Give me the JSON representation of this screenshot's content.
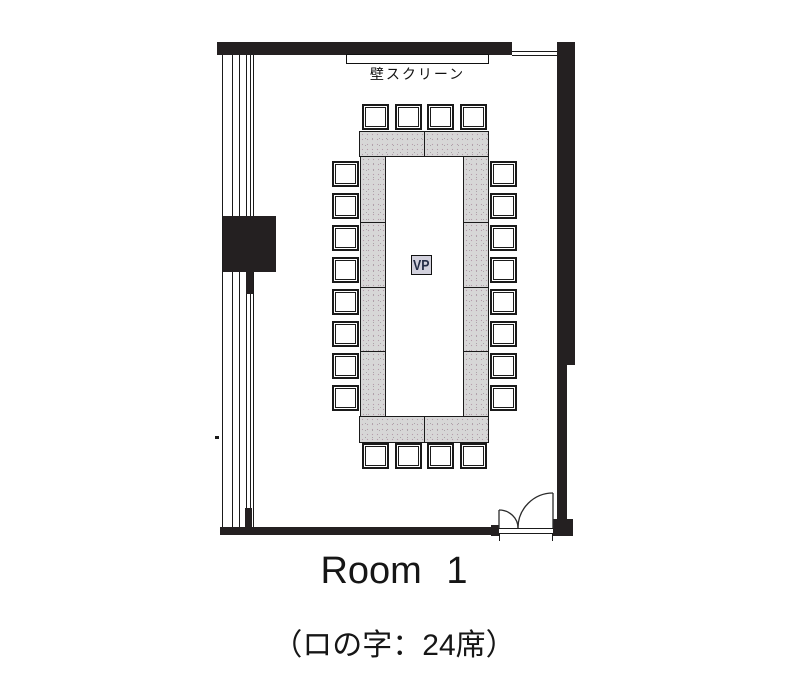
{
  "floorplan": {
    "screen_label": "壁スクリーン",
    "projector_label": "VP",
    "title": "Room 1",
    "caption": "（ロの字：24席）",
    "layout_type": "ロの字",
    "seat_total": 24,
    "seats": {
      "top": 4,
      "bottom": 4,
      "left": 8,
      "right": 8
    },
    "colors": {
      "wall": "#242021",
      "line": "#1a1a1a",
      "table_fill": "#d7d7d7",
      "table_dot": "#b49dab",
      "chair_fill": "#ffffff",
      "projector_fill": "#d2d1dd",
      "projector_text": "#232c45"
    }
  }
}
